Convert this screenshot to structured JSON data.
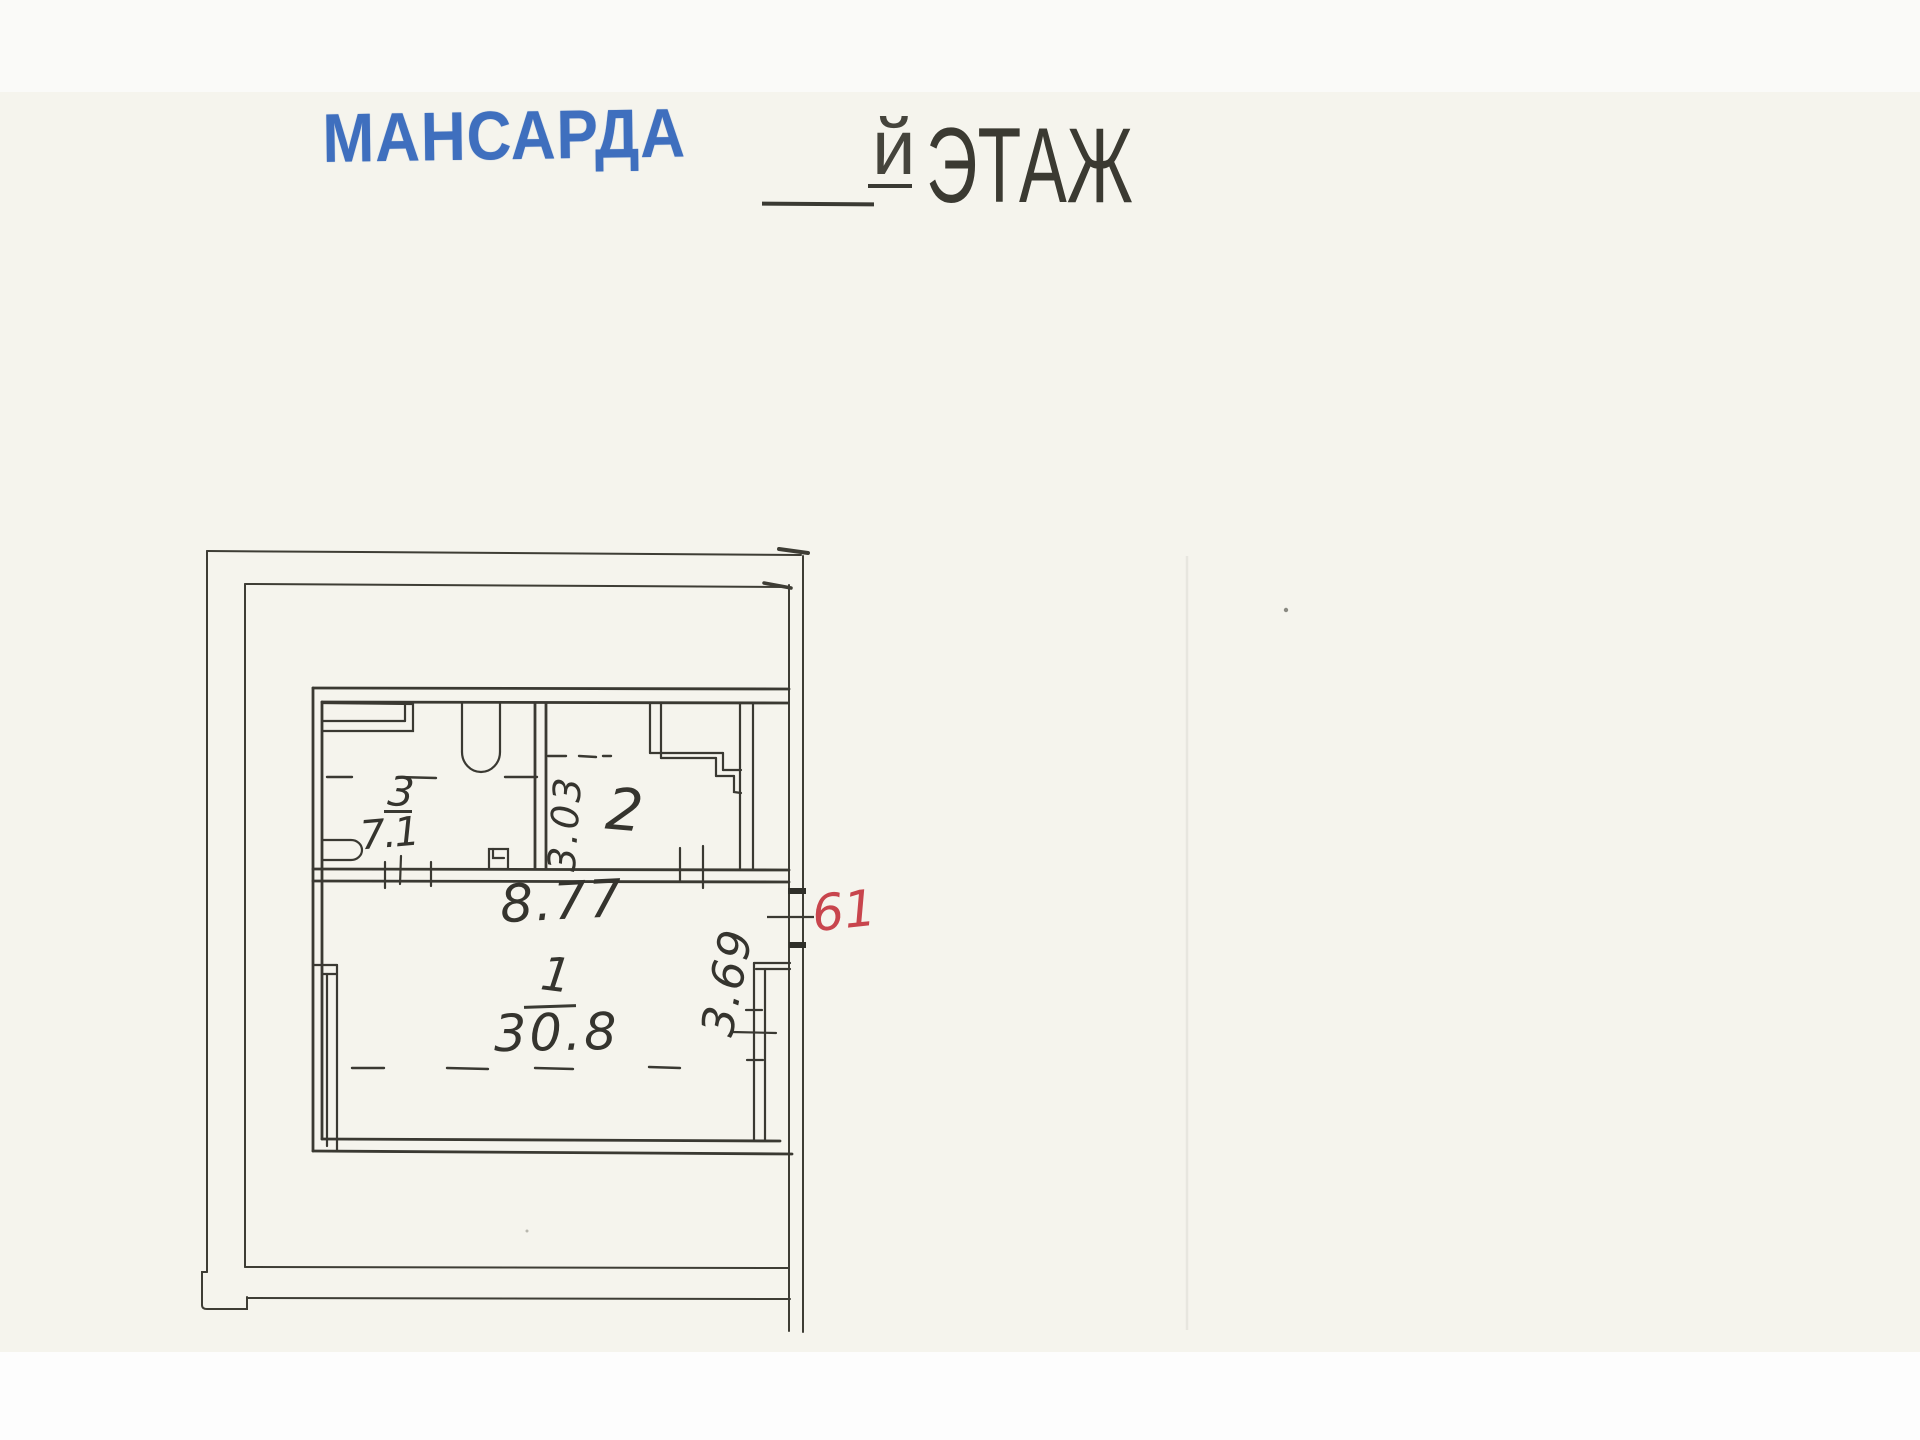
{
  "header": {
    "stamp_text": "МАНСАРДА",
    "floor_blank_suffix": "й",
    "floor_word": "ЭТАЖ"
  },
  "floor_plan": {
    "rooms": [
      {
        "number": "1",
        "area": "30.8"
      },
      {
        "number": "2",
        "area": ""
      },
      {
        "number": "3",
        "area": "7.1"
      }
    ],
    "dimensions": [
      {
        "label": "8.77",
        "orientation": "horizontal",
        "location": "top width of room 1"
      },
      {
        "label": "3.03",
        "orientation": "vertical",
        "location": "depth at wall between rooms 3 and 2"
      },
      {
        "label": "3.69",
        "orientation": "vertical",
        "location": "right side depth of room 1"
      }
    ],
    "apartment_number": "61"
  },
  "colors": {
    "stamp_blue": "#3f6fbe",
    "apartment_number_red": "#c8454d",
    "ink": "#3a3932",
    "paper": "#f5f4ed"
  }
}
